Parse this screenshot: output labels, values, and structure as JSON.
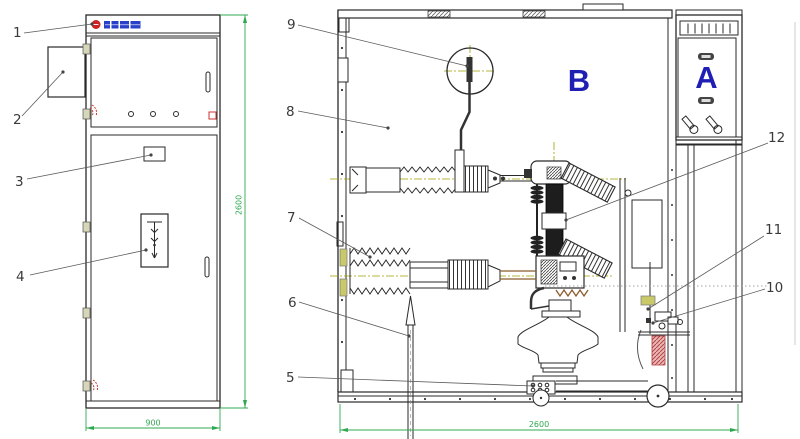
{
  "drawing_type": "switchgear-cabinet-assembly-views",
  "callouts": [
    {
      "label": "1"
    },
    {
      "label": "2"
    },
    {
      "label": "3"
    },
    {
      "label": "4"
    },
    {
      "label": "5"
    },
    {
      "label": "6"
    },
    {
      "label": "7"
    },
    {
      "label": "8"
    },
    {
      "label": "9"
    },
    {
      "label": "10"
    },
    {
      "label": "11"
    },
    {
      "label": "12"
    }
  ],
  "compartments": [
    {
      "label": "B"
    },
    {
      "label": "A"
    }
  ],
  "dimensions": {
    "front_width": "900",
    "front_height": "2600",
    "side_depth": "2600"
  },
  "colors": {
    "dimension_green": "#2fa84f",
    "centerline_olive": "#a0a000",
    "compartment_blue": "#1f1fb4",
    "brand_red": "#cc2222",
    "brand_blue": "#2840c8",
    "interlock_red": "#b23b3b",
    "line": "#2a2a2a"
  }
}
